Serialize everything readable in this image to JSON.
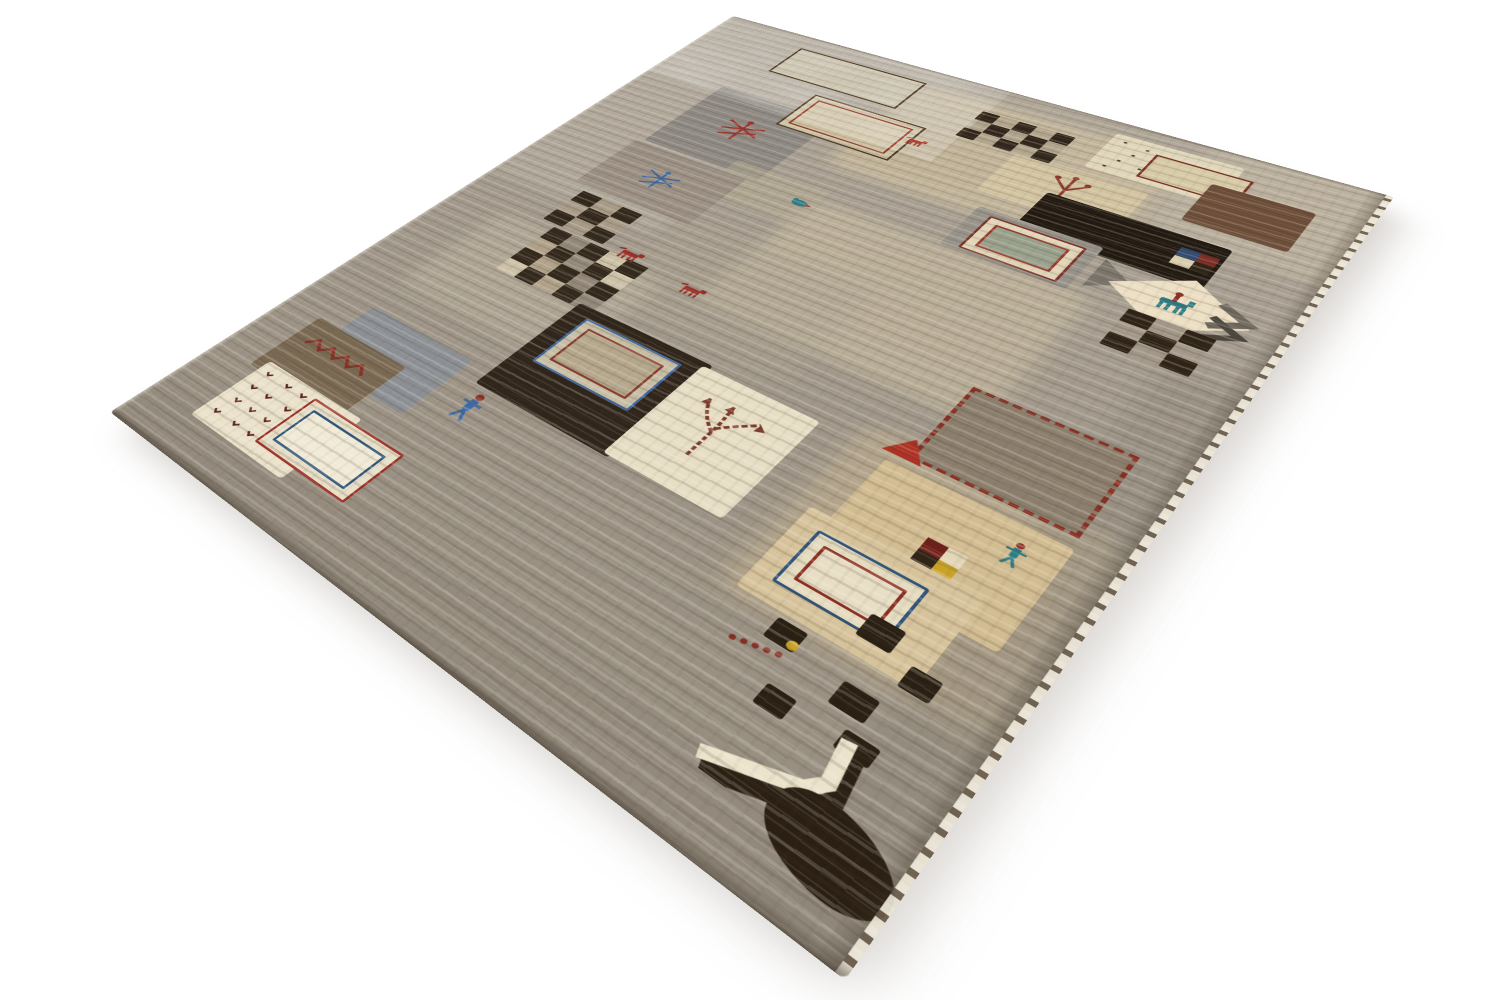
{
  "scene": {
    "type": "product-photo",
    "subject": "Persian Gabbeh patchwork wool rug photographed in perspective on a seamless white background",
    "background_color": "#ffffff"
  },
  "rug": {
    "base_color": "#a49b8e",
    "flat_width": 600,
    "flat_height": 800,
    "corners_px": {
      "top": [
        733,
        16
      ],
      "right": [
        1394,
        197
      ],
      "bottom": [
        845,
        980
      ],
      "left": [
        110,
        412
      ]
    },
    "palette": {
      "cream": "#e9e0c6",
      "beige": "#d3c19c",
      "tan": "#c2a87e",
      "gray": "#968e82",
      "blue_gray": "#8c9095",
      "brown": "#6d4e39",
      "dark_brown": "#30251a",
      "rust_red": "#9c2f26",
      "blue": "#3f68a0",
      "teal": "#2e7d86",
      "gold": "#c9a227",
      "selvedge_white": "#f3eee1"
    },
    "elements": [
      {
        "kind": "tint",
        "name": "light-area",
        "x": 0,
        "y": 70,
        "w": 180,
        "h": 310,
        "color": "#bdb5a8",
        "opacity": 0.45
      },
      {
        "kind": "tint",
        "name": "beige-area",
        "x": 230,
        "y": 28,
        "w": 235,
        "h": 175,
        "color": "#d8c8a2",
        "opacity": 0.5
      },
      {
        "kind": "tint",
        "name": "beige-area",
        "x": 255,
        "y": 255,
        "w": 225,
        "h": 175,
        "color": "#d6c7a4",
        "opacity": 0.42
      },
      {
        "kind": "tint",
        "name": "beige-area",
        "x": 470,
        "y": 0,
        "w": 130,
        "h": 150,
        "color": "#cfc3ab",
        "opacity": 0.4
      },
      {
        "kind": "tint",
        "name": "pebble-area",
        "x": 190,
        "y": 340,
        "w": 170,
        "h": 130,
        "color": "#aba291",
        "opacity": 0.4
      },
      {
        "kind": "tint",
        "name": "light-area",
        "x": 55,
        "y": 425,
        "w": 170,
        "h": 130,
        "color": "#c6bda9",
        "opacity": 0.35
      },
      {
        "kind": "tint",
        "name": "tan-area",
        "x": 425,
        "y": 470,
        "w": 165,
        "h": 180,
        "color": "#d0ba90",
        "opacity": 0.4
      },
      {
        "kind": "tint",
        "name": "dark-edge-area",
        "x": 545,
        "y": 300,
        "w": 55,
        "h": 500,
        "color": "#8a8276",
        "opacity": 0.35
      },
      {
        "kind": "tint",
        "name": "dark-edge-area",
        "x": 0,
        "y": 745,
        "w": 600,
        "h": 55,
        "color": "#8d8478",
        "opacity": 0.35
      },
      {
        "kind": "outline-rect",
        "name": "outlined-rectangle",
        "x": 98,
        "y": 26,
        "w": 130,
        "h": 55,
        "stroke": "#43331f",
        "stroke_width": 2,
        "fill": "#c3baa2"
      },
      {
        "kind": "patch",
        "name": "cream-fleck-patch",
        "x": 402,
        "y": 20,
        "w": 100,
        "h": 66,
        "color": "#e0d6ba"
      },
      {
        "kind": "flecks",
        "name": "fleck-dots",
        "x": 408,
        "y": 26,
        "w": 88,
        "h": 54,
        "color": "#53422e",
        "count": 14
      },
      {
        "kind": "outline-rect",
        "name": "red-outlined-rectangle",
        "x": 440,
        "y": 36,
        "w": 70,
        "h": 38,
        "stroke": "#7c3226",
        "stroke_width": 2,
        "fill": "#d7caa6"
      },
      {
        "kind": "patch",
        "name": "brown-square-patch",
        "x": 490,
        "y": 56,
        "w": 74,
        "h": 64,
        "color": "#6d4e39"
      },
      {
        "kind": "checkerboard",
        "name": "checkerboard",
        "x": 296,
        "y": 46,
        "w": 82,
        "h": 52,
        "rows": 3,
        "cols": 5,
        "dark": "#30251a",
        "lights": [
          "#dcd2b6",
          "#b2a58d"
        ]
      },
      {
        "kind": "patch",
        "name": "beige-band-patch",
        "x": 236,
        "y": 118,
        "w": 110,
        "h": 66,
        "color": "#c0b296",
        "opacity": 0.65
      },
      {
        "kind": "patch",
        "name": "gray-patch",
        "x": 80,
        "y": 136,
        "w": 120,
        "h": 124,
        "color": "#8e8a83"
      },
      {
        "kind": "dragonfly",
        "name": "red-dragonfly-motif",
        "x": 118,
        "y": 175,
        "w": 46,
        "h": 44,
        "color": "#a3322c"
      },
      {
        "kind": "nested-outline",
        "name": "nested-outlined-rectangle",
        "x": 160,
        "y": 101,
        "w": 107,
        "h": 64,
        "outer": "#4a3a26",
        "inner": "#8a3c2e",
        "fill": "#cfc2a4"
      },
      {
        "kind": "patch",
        "name": "beige-patch",
        "x": 350,
        "y": 98,
        "w": 108,
        "h": 70,
        "color": "#d2c4a1"
      },
      {
        "kind": "tree",
        "name": "tree-motif",
        "x": 388,
        "y": 104,
        "w": 34,
        "h": 50,
        "color": "#8e3a2c"
      },
      {
        "kind": "animal",
        "name": "red-animal-motif",
        "x": 264,
        "y": 122,
        "w": 22,
        "h": 12,
        "color": "#9c2f26"
      },
      {
        "kind": "patch",
        "name": "black-rectangle-patch",
        "x": 396,
        "y": 140,
        "w": 138,
        "h": 62,
        "color": "#221a11"
      },
      {
        "kind": "patch",
        "name": "gray-square-patch",
        "x": 363,
        "y": 190,
        "w": 98,
        "h": 66,
        "color": "#98938a"
      },
      {
        "kind": "bordered-motif",
        "name": "bordered-rug-motif",
        "x": 376,
        "y": 198,
        "w": 72,
        "h": 50,
        "frames": [
          "#7c3226",
          "#e0d5b8",
          "#9c3a2c"
        ],
        "center": "#99a08c"
      },
      {
        "kind": "mini-checker",
        "name": "mini-square-motif",
        "x": 504,
        "y": 156,
        "w": 27,
        "h": 25,
        "colors": [
          "#30486e",
          "#7a2a22",
          "#d9cfae",
          "#2f2415"
        ]
      },
      {
        "kind": "patch",
        "name": "beige-band-patch",
        "x": 168,
        "y": 240,
        "w": 90,
        "h": 60,
        "color": "#b6ab92",
        "opacity": 0.5
      },
      {
        "kind": "wedge",
        "name": "gray-wedge",
        "x": 468,
        "y": 203,
        "w": 26,
        "h": 42,
        "color": "#7a746a"
      },
      {
        "kind": "diamond",
        "name": "cream-diamond-patch",
        "x": 480,
        "y": 192,
        "w": 95,
        "h": 74,
        "color": "#ecdfc4"
      },
      {
        "kind": "rider",
        "name": "horse-rider-motif",
        "x": 512,
        "y": 212,
        "w": 30,
        "h": 28,
        "body": "#2e7d86",
        "accent": "#8a2f24"
      },
      {
        "kind": "chevron",
        "name": "chevron-motif",
        "x": 547,
        "y": 206,
        "w": 32,
        "h": 52,
        "color": "#6e685e"
      },
      {
        "kind": "checkerboard",
        "name": "checkerboard",
        "x": 504,
        "y": 252,
        "w": 58,
        "h": 50,
        "rows": 3,
        "cols": 3,
        "dark": "#2e2316",
        "lights": [
          "#d7ccb1",
          "#a29788"
        ]
      },
      {
        "kind": "patch",
        "name": "taupe-patch",
        "x": 74,
        "y": 264,
        "w": 118,
        "h": 86,
        "color": "#9b9083"
      },
      {
        "kind": "dragonfly",
        "name": "blue-dragonfly-motif",
        "x": 112,
        "y": 290,
        "w": 40,
        "h": 36,
        "color": "#3f68a0"
      },
      {
        "kind": "bird",
        "name": "bird-motif",
        "x": 238,
        "y": 260,
        "w": 20,
        "h": 15,
        "color": "#2e7d86"
      },
      {
        "kind": "checkerboard",
        "name": "checkerboard",
        "x": 90,
        "y": 360,
        "w": 64,
        "h": 54,
        "rows": 3,
        "cols": 3,
        "dark": "#32271b",
        "lights": [
          "#d5cab0",
          "#a89b87"
        ]
      },
      {
        "kind": "checkerboard",
        "name": "checkerboard",
        "x": 106,
        "y": 418,
        "w": 98,
        "h": 74,
        "rows": 4,
        "cols": 5,
        "dark": "#33281c",
        "lights": [
          "#cdc2a8",
          "#93887a",
          "#b0a189"
        ]
      },
      {
        "kind": "animal",
        "name": "red-animal-motif",
        "x": 168,
        "y": 406,
        "w": 27,
        "h": 14,
        "color": "#9c2f26"
      },
      {
        "kind": "animal",
        "name": "red-animal-motif",
        "x": 236,
        "y": 416,
        "w": 25,
        "h": 13,
        "color": "#9c2f26"
      },
      {
        "kind": "stitched-square",
        "name": "stitched-square-patch",
        "x": 460,
        "y": 396,
        "w": 102,
        "h": 82,
        "color": "#8b7e6c",
        "stitch": "#8a2f24"
      },
      {
        "kind": "triangle",
        "name": "red-triangle-motif",
        "x": 443,
        "y": 466,
        "w": 27,
        "h": 21,
        "color": "#ae3124"
      },
      {
        "kind": "patch",
        "name": "dark-brown-patch",
        "x": 190,
        "y": 486,
        "w": 122,
        "h": 120,
        "color": "#30251a"
      },
      {
        "kind": "bordered-motif",
        "name": "bordered-rug-motif",
        "x": 206,
        "y": 498,
        "w": 84,
        "h": 60,
        "frames": [
          "#3f68a0",
          "#c7bea5",
          "#8a3c2e"
        ],
        "center": "#b5a78c"
      },
      {
        "kind": "patch",
        "name": "cream-patch",
        "x": 306,
        "y": 490,
        "w": 94,
        "h": 114,
        "color": "#e7dec5"
      },
      {
        "kind": "tree-branches",
        "name": "branch-motif",
        "x": 318,
        "y": 505,
        "w": 64,
        "h": 66,
        "color": "#7c3a2a"
      },
      {
        "kind": "patch",
        "name": "tan-patch",
        "x": 450,
        "y": 494,
        "w": 120,
        "h": 97,
        "color": "#d2bc91"
      },
      {
        "kind": "mini-checker",
        "name": "mini-square-motif",
        "x": 502,
        "y": 538,
        "w": 25,
        "h": 23,
        "colors": [
          "#6e1f18",
          "#e3d7b8",
          "#2f2415",
          "#c9a227"
        ]
      },
      {
        "kind": "person",
        "name": "person-motif",
        "x": 538,
        "y": 508,
        "w": 15,
        "h": 22,
        "body": "#2e7d86",
        "head": "#8a2f24"
      },
      {
        "kind": "patch",
        "name": "tan-patch",
        "x": 436,
        "y": 560,
        "w": 112,
        "h": 82,
        "color": "#d7c39b"
      },
      {
        "kind": "bordered-motif",
        "name": "bordered-rug-motif",
        "x": 450,
        "y": 574,
        "w": 68,
        "h": 48,
        "frames": [
          "#31557a",
          "#e5dbbf",
          "#8a2f24"
        ],
        "center": "#e8dec5"
      },
      {
        "kind": "squares",
        "name": "dark-square",
        "color": "#291f13",
        "items": [
          [
            506,
            610,
            21,
            19
          ],
          [
            540,
            628,
            18,
            17
          ],
          [
            468,
            646,
            19,
            17
          ],
          [
            518,
            660,
            21,
            18
          ],
          [
            488,
            688,
            18,
            16
          ]
        ]
      },
      {
        "kind": "patch",
        "name": "blue-gray-patch",
        "x": 64,
        "y": 590,
        "w": 108,
        "h": 74,
        "color": "#8c9095"
      },
      {
        "kind": "patch",
        "name": "brown-patch",
        "x": 40,
        "y": 626,
        "w": 98,
        "h": 72,
        "color": "#7a6952"
      },
      {
        "kind": "zigzag",
        "name": "zigzag-stitch-motif",
        "x": 52,
        "y": 640,
        "w": 70,
        "h": 20,
        "color": "#8a2f24"
      },
      {
        "kind": "patch",
        "name": "white-bird-patch",
        "x": 50,
        "y": 686,
        "w": 104,
        "h": 76,
        "color": "#ebe2cb"
      },
      {
        "kind": "bird-dots",
        "name": "bird-flock-motif",
        "x": 58,
        "y": 694,
        "w": 88,
        "h": 60,
        "rows": 4,
        "cols": 5,
        "color": "#5a1f1a"
      },
      {
        "kind": "bordered-motif",
        "name": "bordered-rug-motif",
        "x": 110,
        "y": 692,
        "w": 90,
        "h": 54,
        "frames": [
          "#9c2f26",
          "#e8e0c8",
          "#31557a"
        ],
        "center": "#f0ead6"
      },
      {
        "kind": "person",
        "name": "person-motif",
        "x": 194,
        "y": 612,
        "w": 20,
        "h": 32,
        "body": "#3d6aa8",
        "head": "#8a2f24"
      },
      {
        "kind": "caterpillar",
        "name": "caterpillar-motif",
        "x": 452,
        "y": 666,
        "w": 34,
        "h": 12,
        "color": "#8a2f24"
      },
      {
        "kind": "dot",
        "name": "gold-dot-motif",
        "x": 481,
        "y": 655,
        "w": 7,
        "h": 7,
        "color": "#c9a227"
      },
      {
        "kind": "l-bracket",
        "name": "open-rectangle-motif",
        "x": 476,
        "y": 686,
        "w": 98,
        "h": 70,
        "color": "#ebe3cb",
        "shadow": "#2b2013"
      },
      {
        "kind": "blob",
        "name": "dark-blob",
        "x": 526,
        "y": 730,
        "w": 74,
        "h": 44,
        "color": "#2a1f12"
      }
    ]
  }
}
